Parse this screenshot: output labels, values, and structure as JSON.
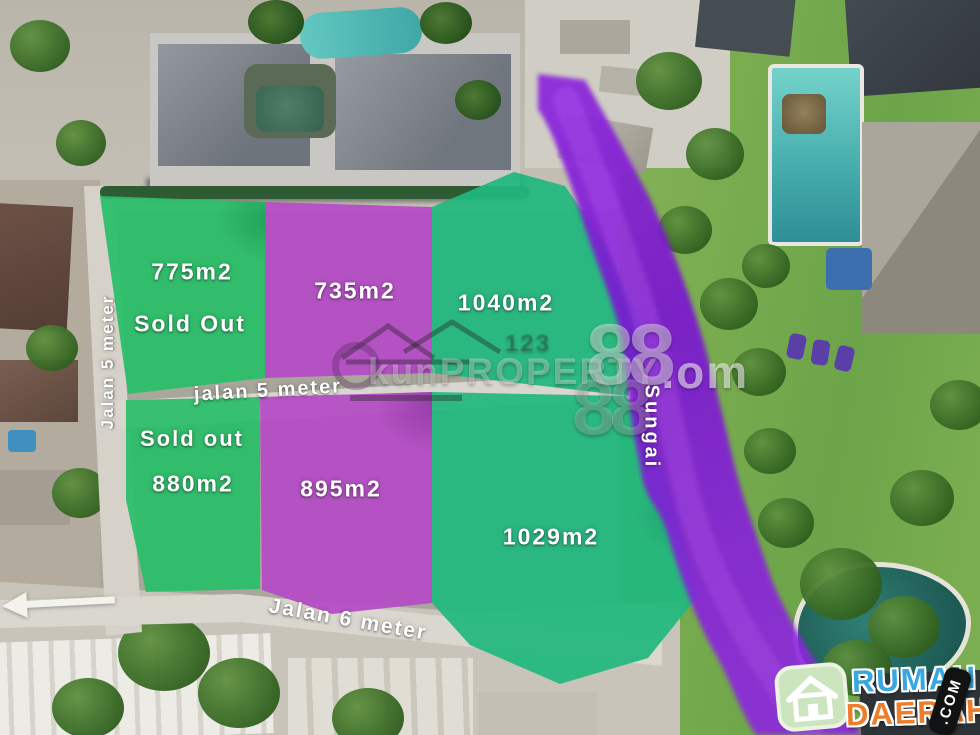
{
  "scene": {
    "description": "Aerial drone photo of six land plots for sale beside a river, overlaid in green and purple"
  },
  "plots": [
    {
      "name": "top-left",
      "overlay": "green",
      "area_label": "775m2",
      "status_label": "Sold Out"
    },
    {
      "name": "top-middle",
      "overlay": "purple",
      "area_label": "735m2",
      "status_label": ""
    },
    {
      "name": "top-right",
      "overlay": "green",
      "area_label": "1040m2",
      "status_label": ""
    },
    {
      "name": "bottom-left",
      "overlay": "green",
      "area_label": "880m2",
      "status_label": "Sold out"
    },
    {
      "name": "bottom-middle",
      "overlay": "purple",
      "area_label": "895m2",
      "status_label": ""
    },
    {
      "name": "bottom-right",
      "overlay": "green",
      "area_label": "1029m2",
      "status_label": ""
    }
  ],
  "roads": {
    "left_vertical_label": "Jalan 5 meter",
    "middle_label": "jalan 5 meter",
    "bottom_label": "Jalan 6 meter"
  },
  "river": {
    "label": "Sungai"
  },
  "watermark": {
    "main_text": "kunPROPERTY",
    "suffix": ".om",
    "ghost_digits": "88",
    "ghost_small": "123"
  },
  "logo": {
    "word_top": "RUMAH",
    "word_bottom": "DAERAH",
    "badge": ".COM"
  },
  "colors": {
    "overlay_green": "#29be68",
    "overlay_green_teal": "#21b87e",
    "overlay_purple": "#b54dc6",
    "river_purple": "#7b1fd2",
    "road_gray": "#d8d4cb",
    "label_text": "#ffffff",
    "logo_blue": "#38a7dd",
    "logo_orange": "#ec7d2b",
    "logo_badge_bg": "#121212",
    "logo_house_bg": "#cde5bf"
  }
}
